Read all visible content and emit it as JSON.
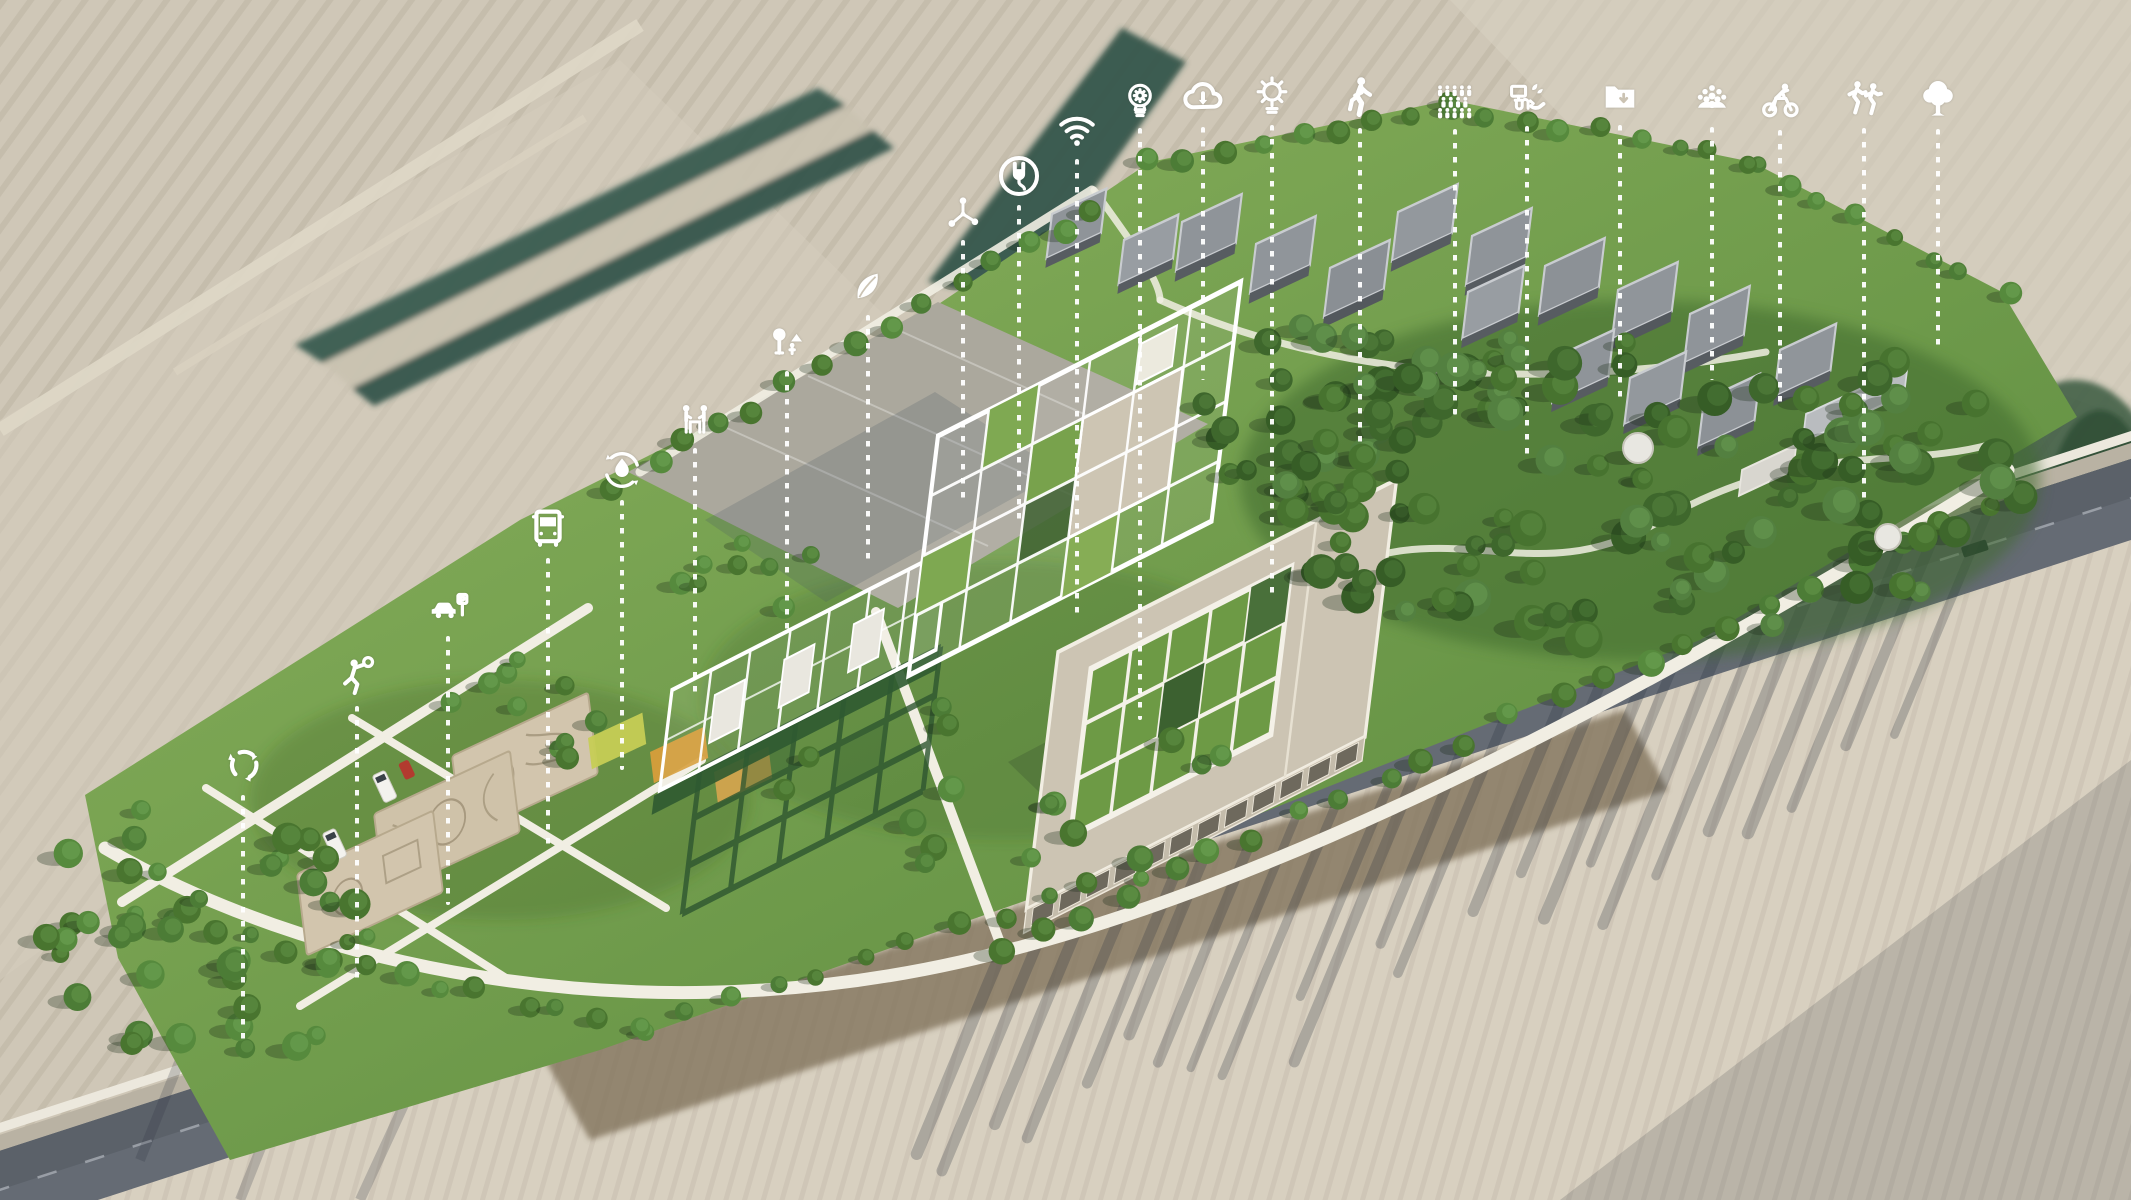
{
  "palette": {
    "field_beige": "#cfc7b7",
    "field_light": "#d8d0c0",
    "hedgerow_teal": "#2f5348",
    "road_asphalt": "#656b74",
    "road_shoulder": "#b9b2a3",
    "site_green_light": "#8db45f",
    "site_green_dark": "#55853a",
    "forest_green": "#3f6a2d",
    "building_roof_beige": "#cdc5b3",
    "structure_white": "#ffffff",
    "plaza_gray": "#aba89d",
    "house_gray": "#8f9499",
    "playground_sand": "#d2c5ad",
    "annotation_white": "#ffffff"
  },
  "annotations": {
    "style": {
      "dot_color": "#ffffff"
    },
    "icons": [
      {
        "name": "recycling",
        "icon": "recycle-icon",
        "x": 243,
        "y": 765,
        "size": 48,
        "line_end_y": 1040
      },
      {
        "name": "ball-sports",
        "icon": "basketball-player-icon",
        "x": 357,
        "y": 677,
        "size": 46,
        "line_end_y": 980
      },
      {
        "name": "parking",
        "icon": "car-parking-icon",
        "x": 448,
        "y": 607,
        "size": 46,
        "line_end_y": 905
      },
      {
        "name": "public-transport",
        "icon": "bus-icon",
        "x": 548,
        "y": 528,
        "size": 48,
        "line_end_y": 845
      },
      {
        "name": "water-recycling",
        "icon": "water-drop-cycle-icon",
        "x": 622,
        "y": 470,
        "size": 48,
        "line_end_y": 770
      },
      {
        "name": "outdoor-workshop",
        "icon": "people-at-table-icon",
        "x": 695,
        "y": 420,
        "size": 44,
        "line_end_y": 700
      },
      {
        "name": "park-recreation",
        "icon": "tree-and-person-icon",
        "x": 787,
        "y": 343,
        "size": 44,
        "line_end_y": 630
      },
      {
        "name": "sustainability",
        "icon": "leaf-icon",
        "x": 868,
        "y": 288,
        "size": 42,
        "line_end_y": 560
      },
      {
        "name": "connectivity-network",
        "icon": "molecule-icon",
        "x": 963,
        "y": 213,
        "size": 42,
        "line_end_y": 500
      },
      {
        "name": "ev-charging",
        "icon": "power-plug-icon",
        "x": 1019,
        "y": 176,
        "size": 46,
        "line_end_y": 520
      },
      {
        "name": "wifi-connectivity",
        "icon": "wifi-icon",
        "x": 1077,
        "y": 130,
        "size": 46,
        "line_end_y": 620
      },
      {
        "name": "innovation",
        "icon": "lightbulb-gear-icon",
        "x": 1140,
        "y": 100,
        "size": 44,
        "line_end_y": 720
      },
      {
        "name": "cloud-services",
        "icon": "cloud-download-icon",
        "x": 1203,
        "y": 98,
        "size": 46,
        "line_end_y": 380
      },
      {
        "name": "solar-energy",
        "icon": "sun-lightbulb-icon",
        "x": 1272,
        "y": 96,
        "size": 46,
        "line_end_y": 600
      },
      {
        "name": "walkability",
        "icon": "pedestrian-icon",
        "x": 1360,
        "y": 98,
        "size": 48,
        "line_end_y": 450
      },
      {
        "name": "community-crowd",
        "icon": "crowd-icon",
        "x": 1455,
        "y": 100,
        "size": 46,
        "line_end_y": 415
      },
      {
        "name": "smart-farming",
        "icon": "monitor-plant-hand-icon",
        "x": 1527,
        "y": 98,
        "size": 44,
        "line_end_y": 455
      },
      {
        "name": "data-archive",
        "icon": "folder-download-icon",
        "x": 1620,
        "y": 97,
        "size": 44,
        "line_end_y": 405
      },
      {
        "name": "social-gathering",
        "icon": "people-cluster-icon",
        "x": 1712,
        "y": 99,
        "size": 44,
        "line_end_y": 380
      },
      {
        "name": "cycling",
        "icon": "cyclist-icon",
        "x": 1780,
        "y": 101,
        "size": 46,
        "line_end_y": 410
      },
      {
        "name": "running-sports",
        "icon": "runners-icon",
        "x": 1864,
        "y": 99,
        "size": 46,
        "line_end_y": 505
      },
      {
        "name": "greenery",
        "icon": "tree-icon",
        "x": 1938,
        "y": 99,
        "size": 48,
        "line_end_y": 350
      }
    ]
  }
}
